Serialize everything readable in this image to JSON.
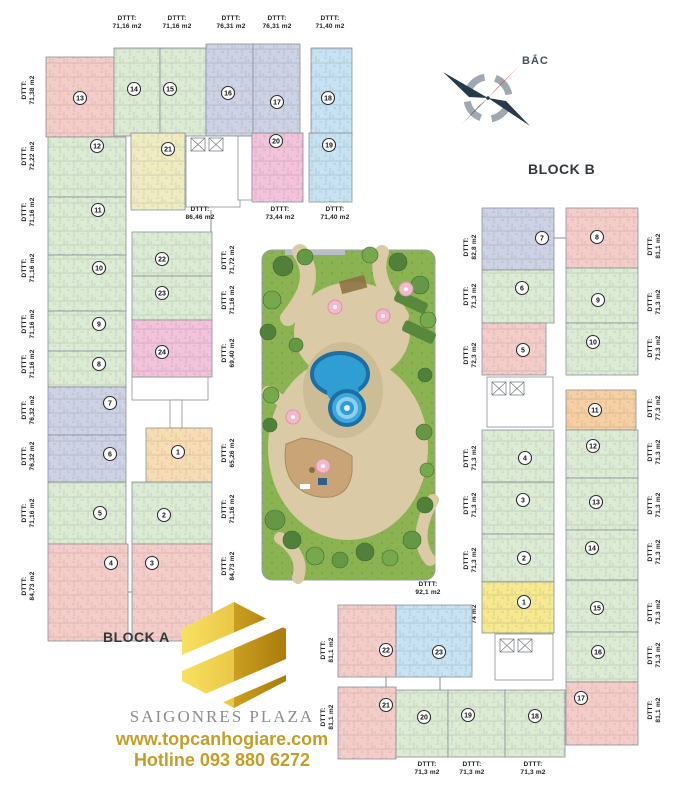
{
  "compass": {
    "label": "BẮC"
  },
  "blocks": {
    "a_label": "BLOCK A",
    "b_label": "BLOCK B"
  },
  "branding": {
    "name": "SAIGONRES PLAZA",
    "website": "www.topcanhogiare.com",
    "hotline": "Hotline 093 880 6272",
    "gold_accent": "#C49E28",
    "logo_gold": "#E3B92A",
    "name_grey": "#8C8C8C"
  },
  "area_prefix": "DTTT:",
  "palette": {
    "green": "#DCEBD4",
    "pink": "#F5CDC8",
    "lavender": "#CDD2E5",
    "blue": "#C6E2F3",
    "yellow": "#F0ECC2",
    "bright_yellow": "#F6E98F",
    "orange": "#F8DDB3",
    "deep_orange": "#F6CFA2",
    "magenta": "#F2C3DA",
    "line": "#8B9197",
    "pool_blue": "#2F9ED2",
    "grass_green": "#8CB352",
    "path_tan": "#DACAA5"
  },
  "floorplan": {
    "units": [
      {
        "id": "a13",
        "n": 13,
        "area": "71,38 m2",
        "color": "pink",
        "x": 46,
        "y": 57,
        "w": 68,
        "h": 80,
        "cx": 80,
        "cy": 98,
        "label": {
          "x": 26,
          "y": 90,
          "rot": 1
        }
      },
      {
        "id": "a14",
        "n": 14,
        "area": "71,16 m2",
        "color": "green",
        "x": 114,
        "y": 48,
        "w": 46,
        "h": 88,
        "cx": 134,
        "cy": 89,
        "label": {
          "x": 127,
          "y": 20,
          "rot": 0
        }
      },
      {
        "id": "a15",
        "n": 15,
        "area": "71,16 m2",
        "color": "green",
        "x": 160,
        "y": 48,
        "w": 46,
        "h": 88,
        "cx": 170,
        "cy": 89,
        "label": {
          "x": 177,
          "y": 20,
          "rot": 0
        }
      },
      {
        "id": "a16",
        "n": 16,
        "area": "76,31 m2",
        "color": "lavender",
        "x": 206,
        "y": 44,
        "w": 47,
        "h": 92,
        "cx": 228,
        "cy": 93,
        "label": {
          "x": 231,
          "y": 20,
          "rot": 0
        }
      },
      {
        "id": "a17",
        "n": 17,
        "area": "76,31 m2",
        "color": "lavender",
        "x": 253,
        "y": 44,
        "w": 47,
        "h": 92,
        "cx": 277,
        "cy": 102,
        "label": {
          "x": 277,
          "y": 20,
          "rot": 0
        }
      },
      {
        "id": "a18",
        "n": 18,
        "area": "71,40 m2",
        "color": "blue",
        "x": 311,
        "y": 48,
        "w": 41,
        "h": 88,
        "cx": 328,
        "cy": 98,
        "label": {
          "x": 330,
          "y": 20,
          "rot": 0
        }
      },
      {
        "id": "a21",
        "n": 21,
        "area": "86,46 m2",
        "color": "yellow",
        "x": 131,
        "y": 133,
        "w": 54,
        "h": 77,
        "cx": 168,
        "cy": 149,
        "label": {
          "x": 200,
          "y": 211,
          "rot": 0
        }
      },
      {
        "id": "a20",
        "n": 20,
        "area": "73,44 m2",
        "color": "magenta",
        "x": 252,
        "y": 133,
        "w": 51,
        "h": 69,
        "cx": 276,
        "cy": 141,
        "label": {
          "x": 280,
          "y": 211,
          "rot": 0
        }
      },
      {
        "id": "a19",
        "n": 19,
        "area": "71,40 m2",
        "color": "blue",
        "x": 309,
        "y": 133,
        "w": 43,
        "h": 69,
        "cx": 329,
        "cy": 145,
        "label": {
          "x": 335,
          "y": 211,
          "rot": 0
        }
      },
      {
        "id": "a12",
        "n": 12,
        "area": "72,22 m2",
        "color": "green",
        "x": 48,
        "y": 137,
        "w": 78,
        "h": 60,
        "cx": 97,
        "cy": 146,
        "label": {
          "x": 26,
          "y": 156,
          "rot": 1
        }
      },
      {
        "id": "a11",
        "n": 11,
        "area": "71,16 m2",
        "color": "green",
        "x": 48,
        "y": 197,
        "w": 78,
        "h": 58,
        "cx": 98,
        "cy": 210,
        "label": {
          "x": 26,
          "y": 212,
          "rot": 1
        }
      },
      {
        "id": "a10",
        "n": 10,
        "area": "71,16 m2",
        "color": "green",
        "x": 48,
        "y": 255,
        "w": 78,
        "h": 56,
        "cx": 99,
        "cy": 268,
        "label": {
          "x": 26,
          "y": 268,
          "rot": 1
        }
      },
      {
        "id": "a9",
        "n": 9,
        "area": "71,16 m2",
        "color": "green",
        "x": 48,
        "y": 311,
        "w": 78,
        "h": 40,
        "cx": 99,
        "cy": 324,
        "label": {
          "x": 26,
          "y": 324,
          "rot": 1
        }
      },
      {
        "id": "a8",
        "n": 8,
        "area": "71,16 m2",
        "color": "green",
        "x": 48,
        "y": 351,
        "w": 78,
        "h": 36,
        "cx": 99,
        "cy": 364,
        "label": {
          "x": 26,
          "y": 364,
          "rot": 1
        }
      },
      {
        "id": "a7",
        "n": 7,
        "area": "76,32 m2",
        "color": "lavender",
        "x": 48,
        "y": 387,
        "w": 78,
        "h": 48,
        "cx": 110,
        "cy": 403,
        "label": {
          "x": 26,
          "y": 410,
          "rot": 1
        }
      },
      {
        "id": "a6",
        "n": 6,
        "area": "76,32 m2",
        "color": "lavender",
        "x": 48,
        "y": 435,
        "w": 78,
        "h": 47,
        "cx": 110,
        "cy": 454,
        "label": {
          "x": 26,
          "y": 456,
          "rot": 1
        }
      },
      {
        "id": "a5",
        "n": 5,
        "area": "71,16 m2",
        "color": "green",
        "x": 48,
        "y": 482,
        "w": 78,
        "h": 62,
        "cx": 100,
        "cy": 513,
        "label": {
          "x": 26,
          "y": 513,
          "rot": 1
        }
      },
      {
        "id": "a4",
        "n": 4,
        "area": "84,73 m2",
        "color": "pink",
        "x": 48,
        "y": 544,
        "w": 80,
        "h": 97,
        "cx": 111,
        "cy": 563,
        "label": {
          "x": 26,
          "y": 586,
          "rot": 1
        }
      },
      {
        "id": "a22",
        "n": 22,
        "area": "71,72 m2",
        "color": "green",
        "x": 132,
        "y": 232,
        "w": 80,
        "h": 44,
        "cx": 162,
        "cy": 259,
        "label": {
          "x": 226,
          "y": 260,
          "rot": 1
        }
      },
      {
        "id": "a23",
        "n": 23,
        "area": "71,16 m2",
        "color": "green",
        "x": 132,
        "y": 276,
        "w": 80,
        "h": 44,
        "cx": 162,
        "cy": 293,
        "label": {
          "x": 226,
          "y": 300,
          "rot": 1
        }
      },
      {
        "id": "a24",
        "n": 24,
        "area": "69,40 m2",
        "color": "magenta",
        "x": 132,
        "y": 320,
        "w": 80,
        "h": 57,
        "cx": 162,
        "cy": 352,
        "label": {
          "x": 226,
          "y": 353,
          "rot": 1
        }
      },
      {
        "id": "a1",
        "n": 1,
        "area": "65,26 m2",
        "color": "orange",
        "x": 146,
        "y": 428,
        "w": 66,
        "h": 54,
        "cx": 178,
        "cy": 452,
        "label": {
          "x": 226,
          "y": 453,
          "rot": 1
        }
      },
      {
        "id": "a2",
        "n": 2,
        "area": "71,16 m2",
        "color": "green",
        "x": 132,
        "y": 482,
        "w": 80,
        "h": 62,
        "cx": 164,
        "cy": 515,
        "label": {
          "x": 226,
          "y": 509,
          "rot": 1
        }
      },
      {
        "id": "a3",
        "n": 3,
        "area": "84,73 m2",
        "color": "pink",
        "x": 132,
        "y": 544,
        "w": 80,
        "h": 97,
        "cx": 152,
        "cy": 563,
        "label": {
          "x": 226,
          "y": 566,
          "rot": 1
        }
      },
      {
        "id": "b7",
        "n": 7,
        "area": "82,8 m2",
        "color": "lavender",
        "x": 482,
        "y": 208,
        "w": 72,
        "h": 62,
        "cx": 542,
        "cy": 238,
        "label": {
          "x": 468,
          "y": 247,
          "rot": 1
        }
      },
      {
        "id": "b6",
        "n": 6,
        "area": "71,3 m2",
        "color": "green",
        "x": 482,
        "y": 270,
        "w": 72,
        "h": 53,
        "cx": 522,
        "cy": 288,
        "label": {
          "x": 468,
          "y": 296,
          "rot": 1
        }
      },
      {
        "id": "b5",
        "n": 5,
        "area": "72,3 m2",
        "color": "pink",
        "x": 482,
        "y": 323,
        "w": 64,
        "h": 52,
        "cx": 523,
        "cy": 350,
        "label": {
          "x": 468,
          "y": 355,
          "rot": 1
        }
      },
      {
        "id": "b4",
        "n": 4,
        "area": "71,3 m2",
        "color": "green",
        "x": 482,
        "y": 430,
        "w": 72,
        "h": 52,
        "cx": 525,
        "cy": 458,
        "label": {
          "x": 468,
          "y": 458,
          "rot": 1
        }
      },
      {
        "id": "b3",
        "n": 3,
        "area": "71,3 m2",
        "color": "green",
        "x": 482,
        "y": 482,
        "w": 72,
        "h": 52,
        "cx": 523,
        "cy": 500,
        "label": {
          "x": 468,
          "y": 505,
          "rot": 1
        }
      },
      {
        "id": "b2",
        "n": 2,
        "area": "71,3 m2",
        "color": "green",
        "x": 482,
        "y": 534,
        "w": 72,
        "h": 48,
        "cx": 524,
        "cy": 558,
        "label": {
          "x": 468,
          "y": 560,
          "rot": 1
        }
      },
      {
        "id": "b1",
        "n": 1,
        "area": "74 m2",
        "color": "bright_yellow",
        "x": 482,
        "y": 582,
        "w": 72,
        "h": 51,
        "cx": 524,
        "cy": 602,
        "label": {
          "x": 468,
          "y": 614,
          "rot": 1
        }
      },
      {
        "id": "b8",
        "n": 8,
        "area": "81,1 m2",
        "color": "pink",
        "x": 566,
        "y": 208,
        "w": 72,
        "h": 60,
        "cx": 597,
        "cy": 237,
        "label": {
          "x": 652,
          "y": 246,
          "rot": 1
        }
      },
      {
        "id": "b9",
        "n": 9,
        "area": "71,3 m2",
        "color": "green",
        "x": 566,
        "y": 268,
        "w": 72,
        "h": 55,
        "cx": 598,
        "cy": 300,
        "label": {
          "x": 652,
          "y": 302,
          "rot": 1
        }
      },
      {
        "id": "b10",
        "n": 10,
        "area": "71,3 m2",
        "color": "green",
        "x": 566,
        "y": 323,
        "w": 72,
        "h": 52,
        "cx": 593,
        "cy": 342,
        "label": {
          "x": 652,
          "y": 348,
          "rot": 1
        }
      },
      {
        "id": "b11",
        "n": 11,
        "area": "77,3 m2",
        "color": "deep_orange",
        "x": 566,
        "y": 390,
        "w": 70,
        "h": 40,
        "cx": 595,
        "cy": 410,
        "label": {
          "x": 652,
          "y": 408,
          "rot": 1
        }
      },
      {
        "id": "b12",
        "n": 12,
        "area": "71,3 m2",
        "color": "green",
        "x": 566,
        "y": 430,
        "w": 72,
        "h": 48,
        "cx": 593,
        "cy": 446,
        "label": {
          "x": 652,
          "y": 452,
          "rot": 1
        }
      },
      {
        "id": "b13",
        "n": 13,
        "area": "71,3 m2",
        "color": "green",
        "x": 566,
        "y": 478,
        "w": 72,
        "h": 52,
        "cx": 596,
        "cy": 502,
        "label": {
          "x": 652,
          "y": 505,
          "rot": 1
        }
      },
      {
        "id": "b14",
        "n": 14,
        "area": "71,3 m2",
        "color": "green",
        "x": 566,
        "y": 530,
        "w": 72,
        "h": 50,
        "cx": 592,
        "cy": 548,
        "label": {
          "x": 652,
          "y": 552,
          "rot": 1
        }
      },
      {
        "id": "b15",
        "n": 15,
        "area": "71,3 m2",
        "color": "green",
        "x": 566,
        "y": 580,
        "w": 72,
        "h": 52,
        "cx": 597,
        "cy": 608,
        "label": {
          "x": 652,
          "y": 612,
          "rot": 1
        }
      },
      {
        "id": "b16",
        "n": 16,
        "area": "71,3 m2",
        "color": "green",
        "x": 566,
        "y": 632,
        "w": 72,
        "h": 50,
        "cx": 598,
        "cy": 652,
        "label": {
          "x": 652,
          "y": 655,
          "rot": 1
        }
      },
      {
        "id": "b17",
        "n": 17,
        "area": "81,1 m2",
        "color": "pink",
        "x": 566,
        "y": 682,
        "w": 72,
        "h": 63,
        "cx": 581,
        "cy": 698,
        "label": {
          "x": 652,
          "y": 710,
          "rot": 1
        }
      },
      {
        "id": "b22",
        "n": 22,
        "area": "81,1 m2",
        "color": "pink",
        "x": 338,
        "y": 605,
        "w": 58,
        "h": 72,
        "cx": 386,
        "cy": 650,
        "label": {
          "x": 325,
          "y": 650,
          "rot": 1
        }
      },
      {
        "id": "b23",
        "n": 23,
        "area": "92,1 m2",
        "color": "blue",
        "x": 396,
        "y": 605,
        "w": 76,
        "h": 72,
        "cx": 439,
        "cy": 652,
        "label": {
          "x": 428,
          "y": 586,
          "rot": 0
        }
      },
      {
        "id": "b21",
        "n": 21,
        "area": "81,1 m2",
        "color": "pink",
        "x": 338,
        "y": 687,
        "w": 58,
        "h": 72,
        "cx": 386,
        "cy": 705,
        "label": {
          "x": 325,
          "y": 717,
          "rot": 1
        }
      },
      {
        "id": "b20",
        "n": 20,
        "area": "71,3 m2",
        "color": "green",
        "x": 396,
        "y": 690,
        "w": 52,
        "h": 67,
        "cx": 424,
        "cy": 717,
        "label": {
          "x": 427,
          "y": 766,
          "rot": 0
        }
      },
      {
        "id": "b19",
        "n": 19,
        "area": "71,3 m2",
        "color": "green",
        "x": 448,
        "y": 690,
        "w": 57,
        "h": 67,
        "cx": 468,
        "cy": 715,
        "label": {
          "x": 472,
          "y": 766,
          "rot": 0
        }
      },
      {
        "id": "b18",
        "n": 18,
        "area": "71,3 m2",
        "color": "green",
        "x": 505,
        "y": 690,
        "w": 60,
        "h": 67,
        "cx": 535,
        "cy": 716,
        "label": {
          "x": 533,
          "y": 766,
          "rot": 0
        }
      }
    ],
    "cores": [
      {
        "x": 186,
        "y": 133,
        "w": 54,
        "h": 74,
        "lifts": 1
      },
      {
        "x": 238,
        "y": 136,
        "w": 14,
        "h": 64,
        "lifts": 0
      },
      {
        "x": 132,
        "y": 377,
        "w": 76,
        "h": 23,
        "lifts": 0
      },
      {
        "x": 170,
        "y": 400,
        "w": 12,
        "h": 28,
        "lifts": 0
      },
      {
        "x": 487,
        "y": 377,
        "w": 66,
        "h": 50,
        "lifts": 1
      },
      {
        "x": 495,
        "y": 634,
        "w": 58,
        "h": 46,
        "lifts": 1
      }
    ],
    "connectors": [
      [
        63,
        137,
        63,
        151
      ],
      [
        230,
        136,
        230,
        146
      ],
      [
        332,
        136,
        332,
        152
      ],
      [
        211,
        210,
        211,
        232
      ],
      [
        554,
        238,
        566,
        238
      ],
      [
        556,
        713,
        566,
        713
      ],
      [
        386,
        677,
        386,
        687
      ],
      [
        440,
        677,
        440,
        690
      ],
      [
        128,
        592,
        132,
        592
      ]
    ]
  }
}
